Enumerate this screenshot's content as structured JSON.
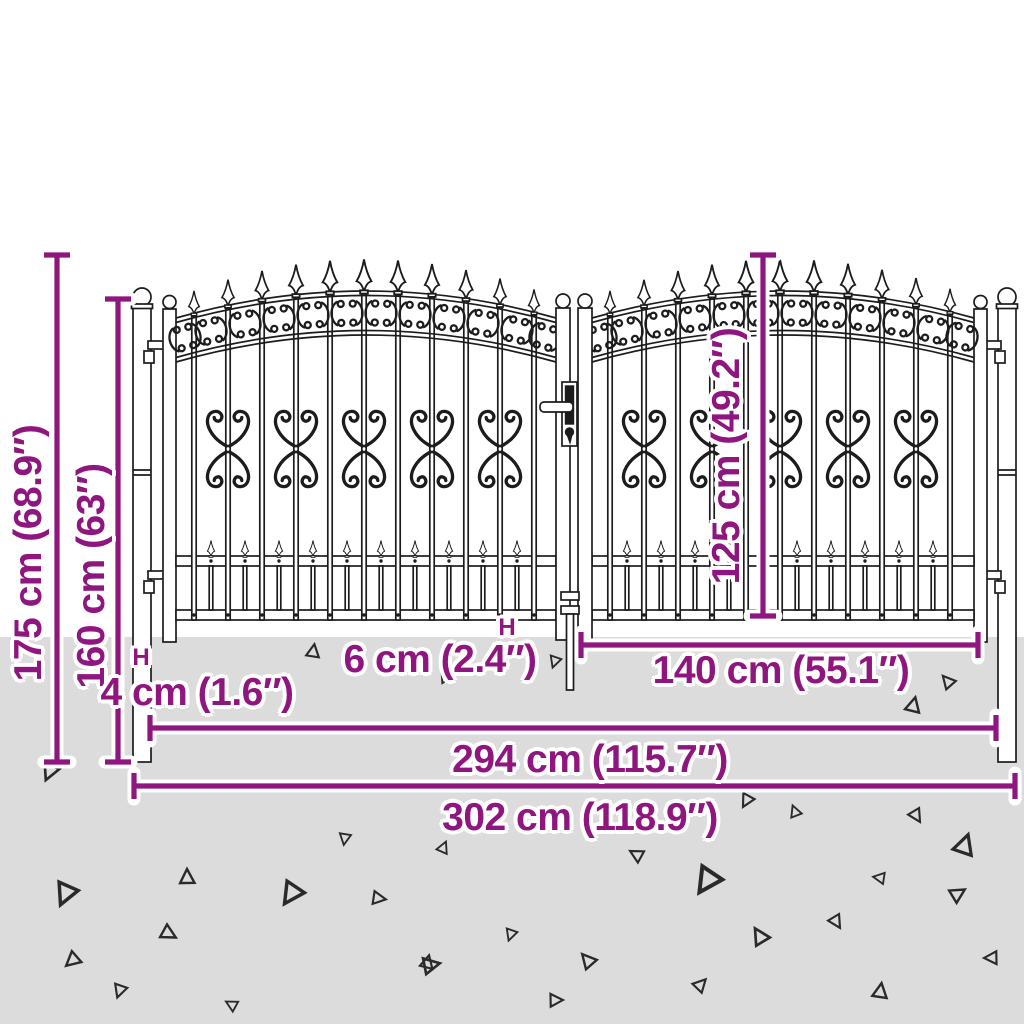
{
  "diagram": {
    "subject": "double-garden-gate-dimension-diagram"
  },
  "dimensions": {
    "total_height": "175 cm (68.9″)",
    "post_height": "160 cm (63″)",
    "leaf_height": "125 cm (49.2″)",
    "ground_clearance": "6 cm (2.4″)",
    "post_width": "4 cm (1.6″)",
    "leaf_width": "140 cm (55.1″)",
    "inner_width": "294 cm (115.7″)",
    "outer_width": "302 cm (118.9″)"
  },
  "markers": {
    "post_width_marker": "H",
    "ground_clearance_marker": "H"
  },
  "icons": {
    "gate_artwork": "wrought-iron-double-gate-illustration",
    "ground_texture": "scattered-triangle-gravel-marks"
  },
  "colors": {
    "dimension_accent": "#8F157F",
    "artwork_line": "#1C1C1C",
    "ground": "#DCDCDC",
    "background": "#FFFFFF"
  }
}
